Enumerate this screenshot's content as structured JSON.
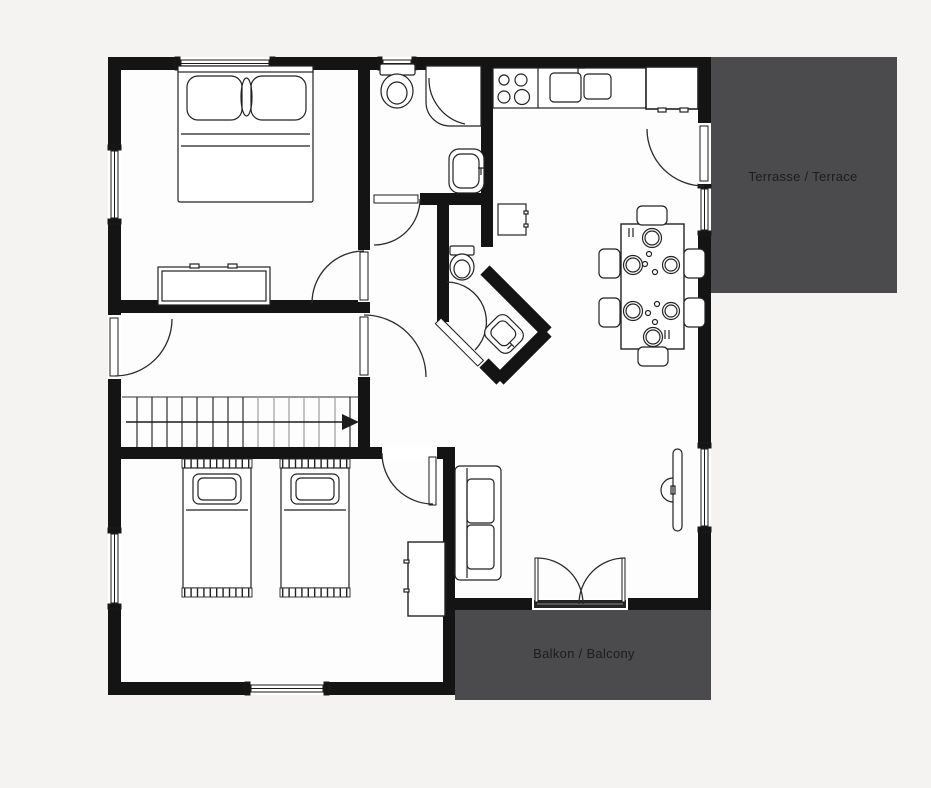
{
  "labels": {
    "terrace": "Terrasse / Terrace",
    "balcony": "Balkon / Balcony"
  },
  "colors": {
    "background": "#f4f3f1",
    "floor": "#fdfdfd",
    "wall": "#141414",
    "outdoor_area": "#4b4b4d",
    "label_text": "#1c1c1c",
    "furniture_line": "#222222",
    "door_arc": "#2a2a2a",
    "stair_dark": "#2e2e2e",
    "stair_light": "#9d9d9d",
    "threshold": "#242424"
  }
}
